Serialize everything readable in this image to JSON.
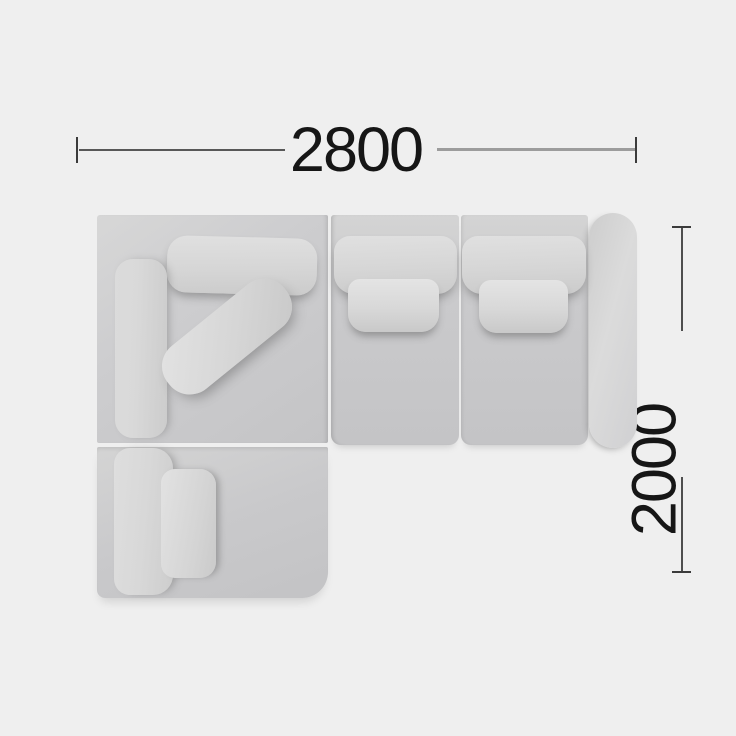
{
  "dimension_labels": {
    "width": "2800",
    "depth": "2000"
  },
  "colors": {
    "background": "#efefef",
    "sofa-base": "#c9c9cb",
    "sofa-cushion": "#dcdcdc",
    "dim-line-dark": "#3b3b3b",
    "dim-line-mid": "#585858",
    "dim-line-light": "#9c9c9c",
    "dim-text": "#161616"
  }
}
